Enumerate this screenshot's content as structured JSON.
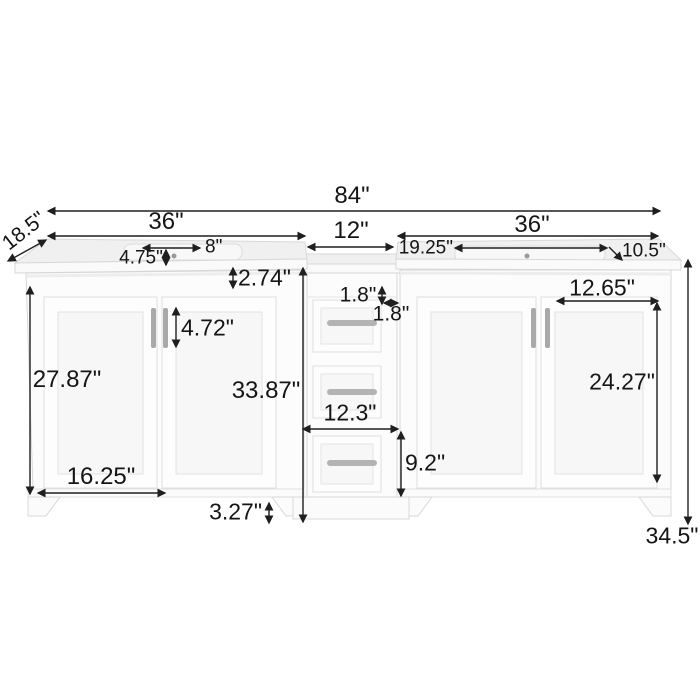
{
  "diagram": {
    "subject": "double-sink bathroom vanity with middle drawer tower",
    "units": "inches"
  },
  "colors": {
    "background": "#ffffff",
    "cabinet": "#fcfcfc",
    "panel": "#f7f7f7",
    "counter_top": "#f0f0f0",
    "outline": "#d8d8d8",
    "handle": "#aaaaaa",
    "dimension_text": "#151515",
    "dimension_arrow": "#1f1f1f"
  },
  "dims": {
    "overall_width": "84\"",
    "depth": "18.5\"",
    "left_vanity_width": "36\"",
    "middle_cabinet_width": "12\"",
    "right_vanity_width": "36\"",
    "left_sink_faucet_span": "8\"",
    "left_sink_inset": "4.75\"",
    "countertop_height": "2.74\"",
    "door_handle_length": "4.72\"",
    "left_door_height": "27.87\"",
    "left_door_width": "16.25\"",
    "toe_kick_height": "3.27\"",
    "middle_cabinet_height": "33.87\"",
    "middle_gap_vertical": "1.8\"",
    "middle_gap_horizontal": "1.8\"",
    "middle_drawer_width": "12.3\"",
    "bottom_drawer_height": "9.2\"",
    "right_sink_left_offset": "19.25\"",
    "right_sink_right_offset": "10.5\"",
    "right_door_width": "12.65\"",
    "right_door_height": "24.27\"",
    "overall_height": "34.5\""
  }
}
